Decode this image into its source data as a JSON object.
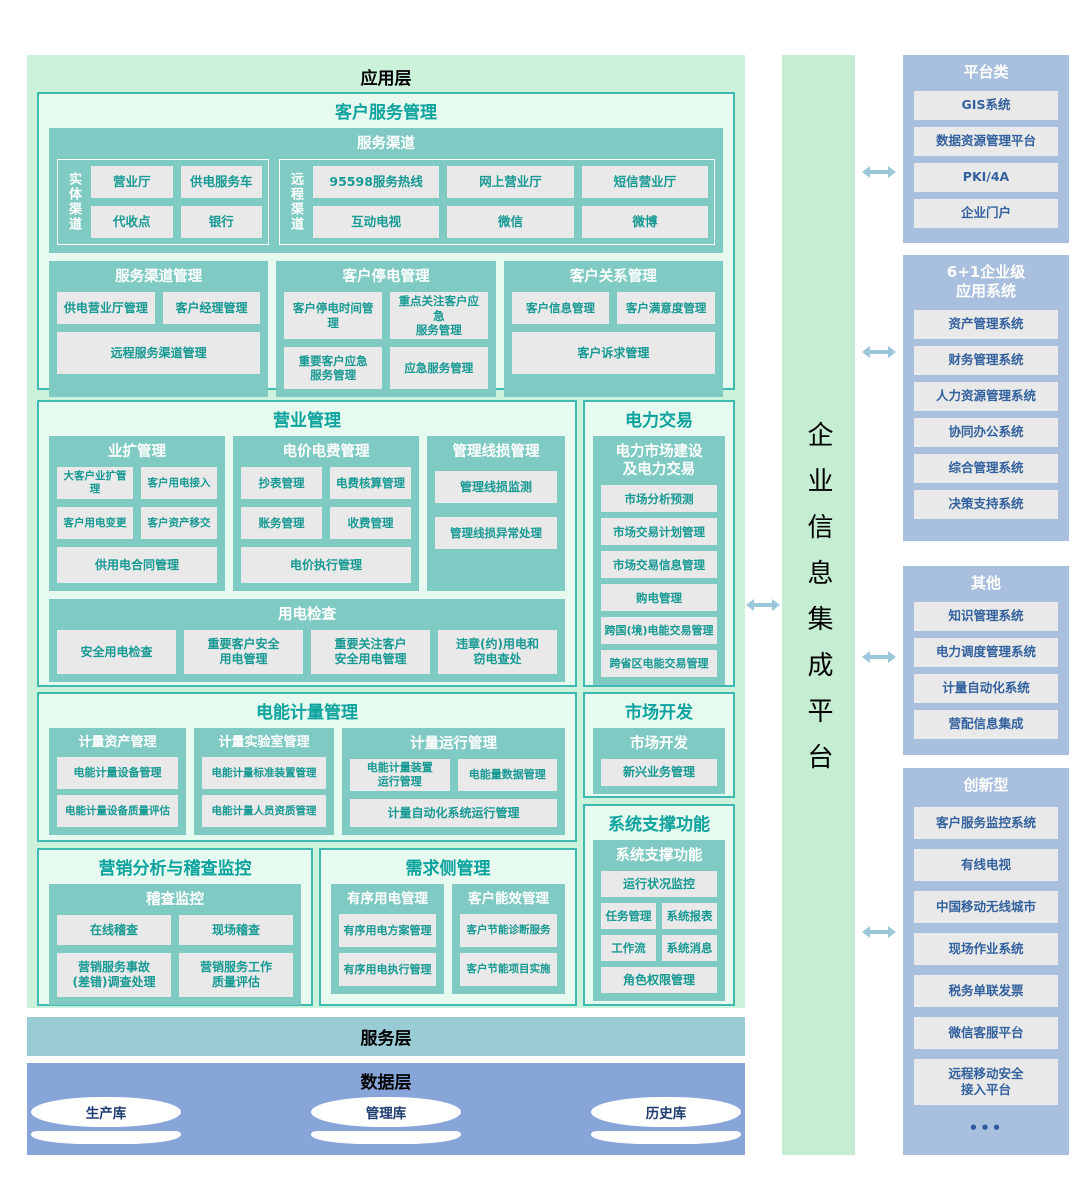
{
  "layers": {
    "application": "应用层",
    "service": "服务层",
    "data": "数据层"
  },
  "customer_service": {
    "title": "客户服务管理",
    "channels": {
      "title": "服务渠道",
      "physical": {
        "label": "实体渠道",
        "items": [
          "营业厅",
          "供电服务车",
          "代收点",
          "银行"
        ]
      },
      "remote": {
        "label": "远程渠道",
        "items": [
          "95598服务热线",
          "网上营业厅",
          "短信营业厅",
          "互动电视",
          "微信",
          "微博"
        ]
      }
    },
    "groups": [
      {
        "title": "服务渠道管理",
        "items": [
          "供电营业厅管理",
          "客户经理管理",
          "远程服务渠道管理"
        ]
      },
      {
        "title": "客户停电管理",
        "items": [
          "客户停电时间管理",
          "重点关注客户应急\n服务管理",
          "重要客户应急\n服务管理",
          "应急服务管理"
        ]
      },
      {
        "title": "客户关系管理",
        "items": [
          "客户信息管理",
          "客户满意度管理",
          "客户诉求管理"
        ]
      }
    ]
  },
  "business": {
    "title": "营业管理",
    "expansion": {
      "title": "业扩管理",
      "items": [
        "大客户业扩管理",
        "客户用电接入",
        "客户用电变更",
        "客户资产移交",
        "供用电合同管理"
      ]
    },
    "price_fee": {
      "title": "电价电费管理",
      "items": [
        "抄表管理",
        "电费核算管理",
        "账务管理",
        "收费管理",
        "电价执行管理"
      ]
    },
    "line_loss": {
      "title": "管理线损管理",
      "items": [
        "管理线损监测",
        "管理线损异常处理"
      ]
    },
    "inspection": {
      "title": "用电检查",
      "items": [
        "安全用电检查",
        "重要客户安全\n用电管理",
        "重要关注客户\n安全用电管理",
        "违章(约)用电和\n窃电查处"
      ]
    }
  },
  "power_trading": {
    "title": "电力交易",
    "group_title": "电力市场建设\n及电力交易",
    "items": [
      "市场分析预测",
      "市场交易计划管理",
      "市场交易信息管理",
      "购电管理",
      "跨国(境)电能交易管理",
      "跨省区电能交易管理"
    ]
  },
  "metering": {
    "title": "电能计量管理",
    "asset": {
      "title": "计量资产管理",
      "items": [
        "电能计量设备管理",
        "电能计量设备质量评估"
      ]
    },
    "lab": {
      "title": "计量实验室管理",
      "items": [
        "电能计量标准装置管理",
        "电能计量人员资质管理"
      ]
    },
    "operation": {
      "title": "计量运行管理",
      "items": [
        "电能计量装置\n运行管理",
        "电能量数据管理",
        "计量自动化系统运行管理"
      ]
    }
  },
  "market_dev": {
    "title": "市场开发",
    "group_title": "市场开发",
    "items": [
      "新兴业务管理"
    ]
  },
  "support": {
    "title": "系统支撑功能",
    "group_title": "系统支撑功能",
    "items": [
      "运行状况监控",
      "任务管理",
      "系统报表",
      "工作流",
      "系统消息",
      "角色权限管理"
    ]
  },
  "marketing_audit": {
    "title": "营销分析与稽查监控",
    "group_title": "稽查监控",
    "items": [
      "在线稽查",
      "现场稽查",
      "营销服务事故\n(差错)调查处理",
      "营销服务工作\n质量评估"
    ]
  },
  "demand_side": {
    "title": "需求侧管理",
    "orderly": {
      "title": "有序用电管理",
      "items": [
        "有序用电方案管理",
        "有序用电执行管理"
      ]
    },
    "efficiency": {
      "title": "客户能效管理",
      "items": [
        "客户节能诊断服务",
        "客户节能项目实施"
      ]
    }
  },
  "data_layer": {
    "databases": [
      "生产库",
      "管理库",
      "历史库"
    ]
  },
  "integration_platform": {
    "title": "企业信息集成平台"
  },
  "right_panel": {
    "platform": {
      "title": "平台类",
      "items": [
        "GIS系统",
        "数据资源管理平台",
        "PKI/4A",
        "企业门户"
      ]
    },
    "enterprise": {
      "title": "6+1企业级\n应用系统",
      "items": [
        "资产管理系统",
        "财务管理系统",
        "人力资源管理系统",
        "协同办公系统",
        "综合管理系统",
        "决策支持系统"
      ]
    },
    "others": {
      "title": "其他",
      "items": [
        "知识管理系统",
        "电力调度管理系统",
        "计量自动化系统",
        "营配信息集成"
      ]
    },
    "innovative": {
      "title": "创新型",
      "items": [
        "客户服务监控系统",
        "有线电视",
        "中国移动无线城市",
        "现场作业系统",
        "税务单联发票",
        "微信客服平台",
        "远程移动安全\n接入平台"
      ],
      "more": "•••"
    }
  },
  "colors": {
    "app_bg": "#cdf2dc",
    "section_bg": "#e7faef",
    "section_border": "#3fbab1",
    "teal_group": "#7fcac3",
    "item_bg": "#e9e9e9",
    "item_text": "#189a94",
    "section_title": "#0da39e",
    "service_band": "#98cbd3",
    "data_band": "#87a5d8",
    "platform_bar_bg": "#c4edd2",
    "right_bg": "#a8bfdd",
    "right_text": "#33629f",
    "arrow": "#9cc7db"
  }
}
